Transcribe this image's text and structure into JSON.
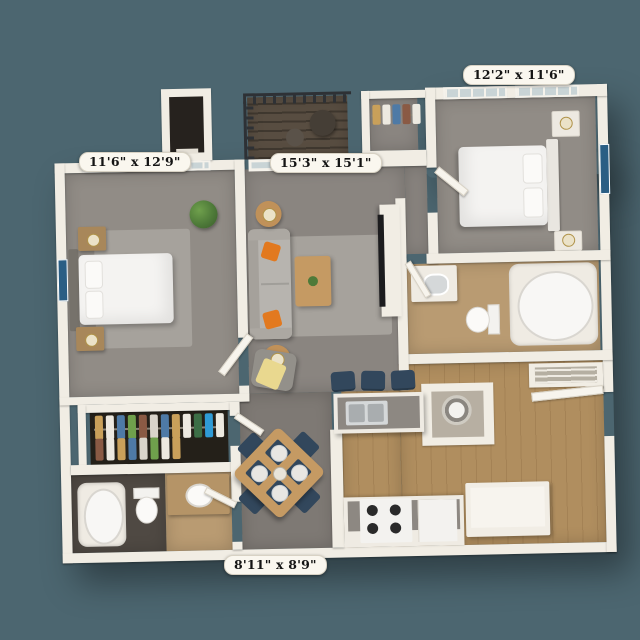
{
  "rooms": [
    {
      "id": "bedroom-1",
      "dimensions": "11'6\" x 12'9\""
    },
    {
      "id": "living-room",
      "dimensions": "15'3\" x 15'1\""
    },
    {
      "id": "bedroom-2",
      "dimensions": "12'2\" x 11'6\""
    },
    {
      "id": "flex-space",
      "dimensions": "8'11\" x 8'9\""
    }
  ],
  "colors": {
    "background": "#4C6670",
    "wall": "#F1EDE4",
    "carpet": "#918C86",
    "carpet_dark": "#7E7974",
    "rug": "#A6A29C",
    "wood_floor": "#B08E5F",
    "balcony_deck": "#584D41",
    "railing": "#2E3135",
    "glass": "#C9D4D6",
    "sofa": "#B7B4AF",
    "armchair": "#93908A",
    "pillow_orange": "#E2791F",
    "navy": "#32475C",
    "table_wood": "#C59A63",
    "nightstand_wood": "#A8875A",
    "bed_white": "#F4F3F1",
    "headboard_gray": "#76726B",
    "art_blue": "#2A5E84",
    "plant_green": "#4E7A39",
    "closet_dark": "#242019",
    "bath_tan": "#B99B72",
    "bath_dark_floor": "#4F4943",
    "stainless": "#D5D8D9",
    "counter_gray": "#8D8882",
    "appliance_white": "#F3F2EF",
    "burner_black": "#2A2A2A",
    "lamp_shade": "#EBE2C8",
    "label_bg": "#FAF7EF",
    "label_text": "#141414"
  }
}
